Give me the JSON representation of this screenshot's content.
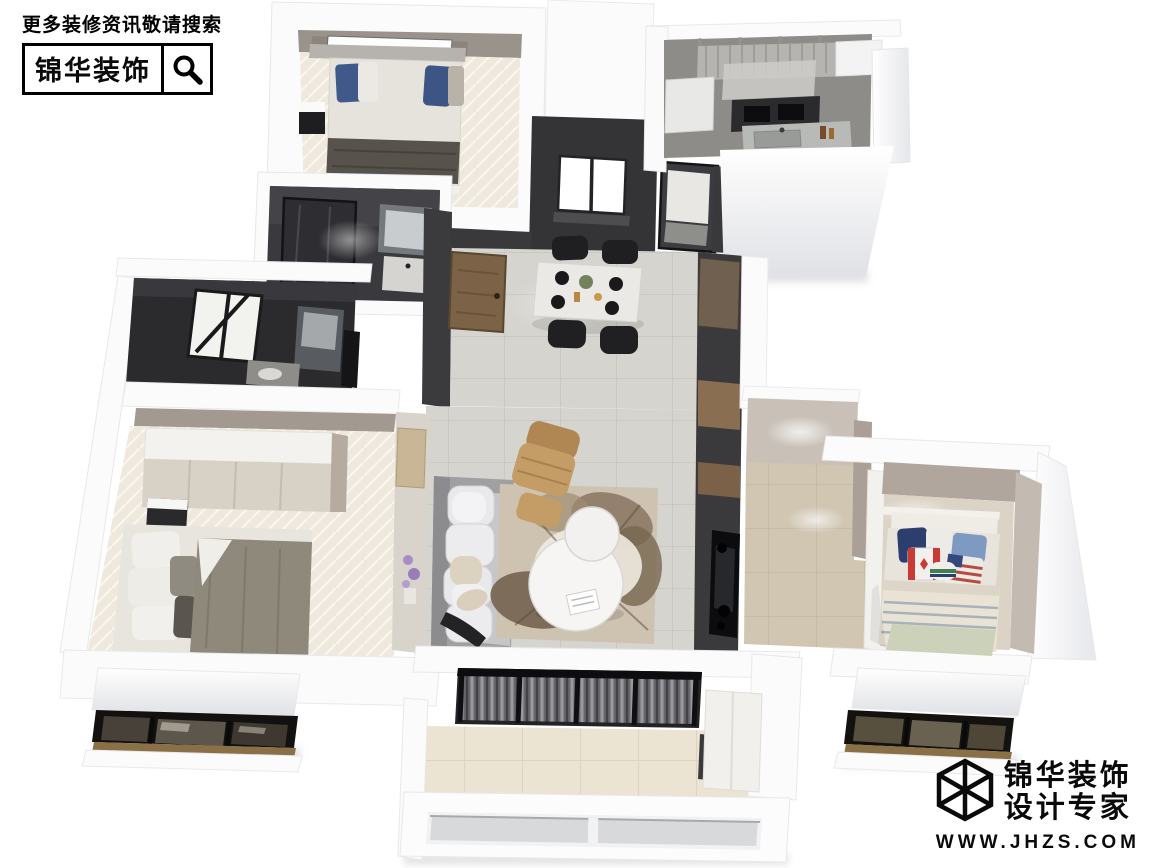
{
  "watermark": {
    "tagline": "更多装修资讯敬请搜索",
    "brand": "锦华装饰",
    "icon": "search-icon"
  },
  "brand": {
    "name": "锦华装饰",
    "tagline": "设计专家",
    "website": "WWW.JHZS.COM",
    "icon": "wireframe-cube-icon"
  },
  "scene": {
    "type": "3d-floorplan-dollhouse-render",
    "view": "top-down isometric",
    "rooms": [
      "bedroom-2",
      "bathroom",
      "master-bathroom",
      "kitchen",
      "entry",
      "dining-area",
      "living-room",
      "hallway",
      "kids-bedroom",
      "master-bedroom",
      "balcony",
      "bay-windows"
    ]
  },
  "colors": {
    "background": "#ffffff",
    "ink": "#0a0a0a",
    "wall_white": "#fbfbfc",
    "wall_shade": "#e0e1e5",
    "charcoal_wall": "#353538",
    "concrete_wall": "#8e8c88",
    "greige_wall": "#b0a69d",
    "gray_tile": "#d5d4cf",
    "cream_tile": "#ebe4d2",
    "herringbone_floor": "#eee8dd",
    "wood_door": "#7c6247",
    "tan_leather": "#c49d66",
    "rug_brown": "#8d7a66",
    "pillow_navy": "#2c3e6d",
    "pillow_blue": "#7e9ac2",
    "flag_red": "#c93a36"
  }
}
